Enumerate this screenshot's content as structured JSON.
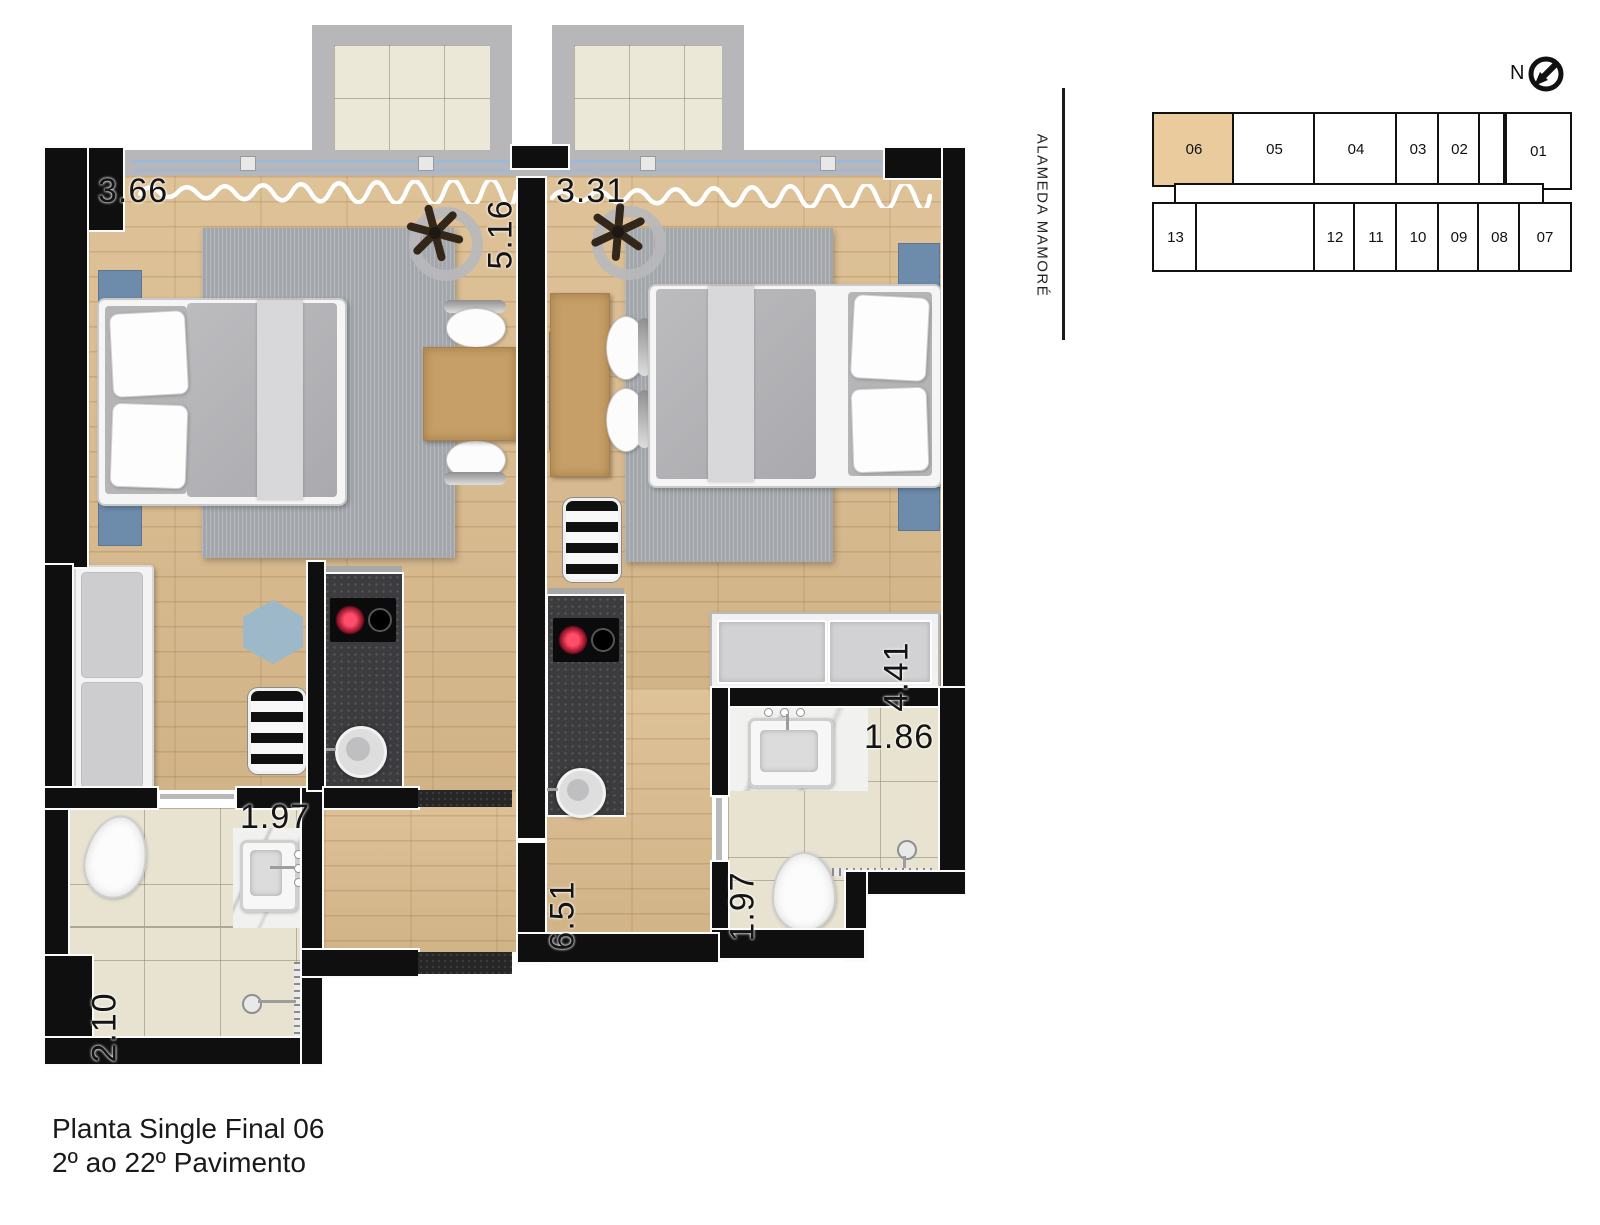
{
  "title": {
    "line1": "Planta Single Final 06",
    "line2": "2º ao 22º Pavimento"
  },
  "compass": {
    "label": "N"
  },
  "street": {
    "name": "ALAMEDA MAMORÉ"
  },
  "keyplan": {
    "highlighted_unit": "06",
    "top_units": [
      "06",
      "05",
      "04",
      "03",
      "02",
      "01"
    ],
    "bottom_units": [
      "13",
      "12",
      "11",
      "10",
      "09",
      "08",
      "07"
    ]
  },
  "dimensions": {
    "left_unit_width": "3.66",
    "left_unit_depth": "5.16",
    "right_unit_width": "3.31",
    "right_wardrobe_length": "4.41",
    "right_bath_width": "1.86",
    "right_bath_depth": "1.97",
    "left_bath_width": "1.97",
    "left_bath_depth": "2.10",
    "right_hall_depth": "6.51"
  },
  "colors": {
    "wall": "#0f0f0f",
    "wood_floor": "#dcbd8f",
    "tile_floor": "#e7e3d0",
    "balcony_slab": "#b7b7ba",
    "rug": "#a3a6ab",
    "nightstand_blue": "#6d8cab",
    "counter_dark": "#3c3c3f",
    "keyplan_highlight": "#e9cb9e"
  }
}
